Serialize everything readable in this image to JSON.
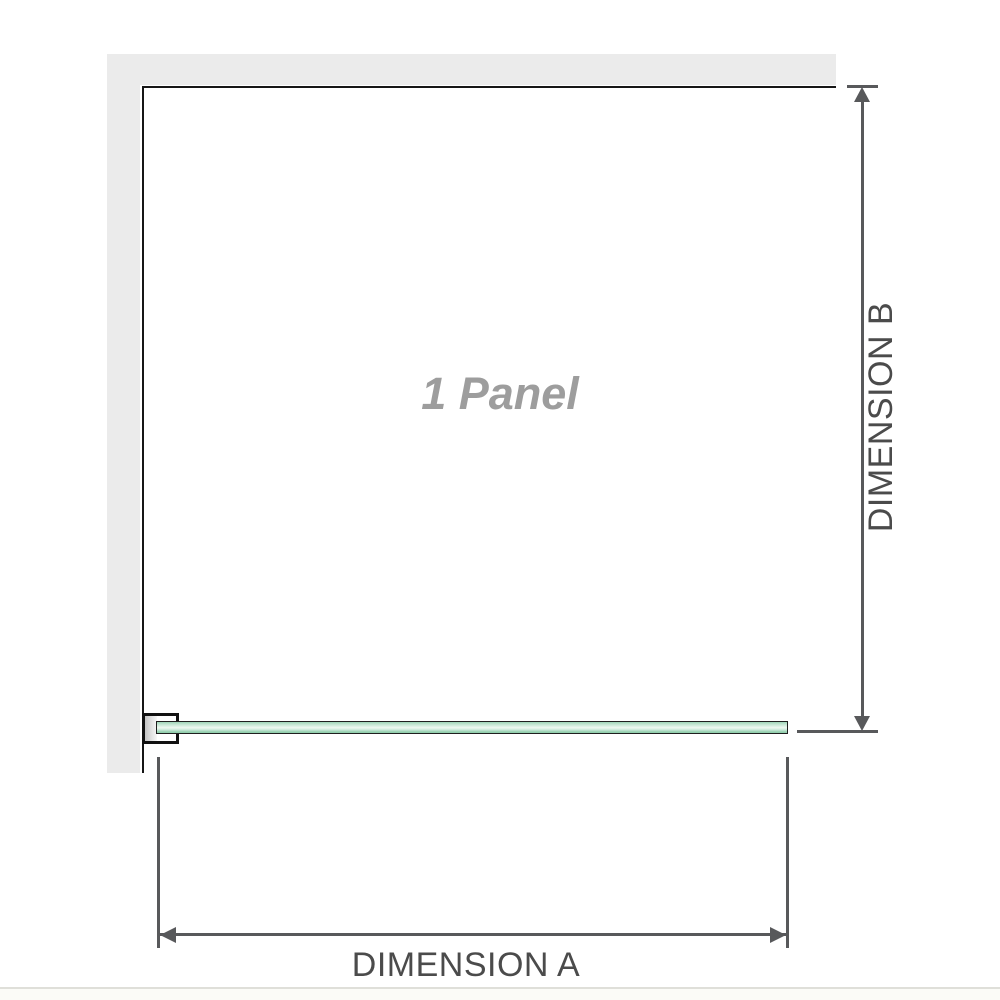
{
  "diagram": {
    "title": "1 Panel",
    "dimension_a_label": "DIMENSION A",
    "dimension_b_label": "DIMENSION B"
  },
  "colors": {
    "wall_gray": "#ebebeb",
    "edge_black": "#161616",
    "dimension_line_gray": "#58595b",
    "label_gray": "#4b4b4b",
    "panel_label_gray": "#9d9d9d",
    "glass_green_light": "#eef8f1",
    "glass_green_mid": "#c9e8d6",
    "glass_green_dark": "#8fcdab"
  }
}
